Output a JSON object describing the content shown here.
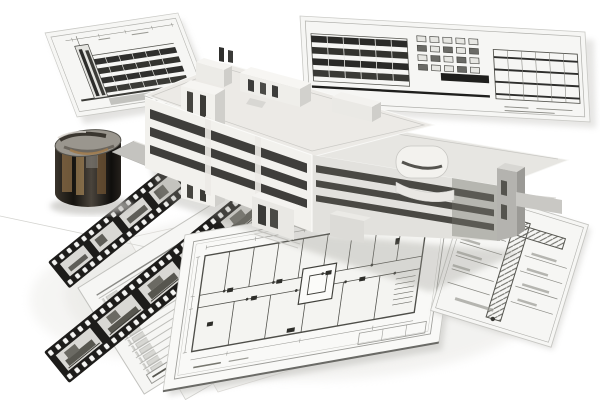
{
  "scene": {
    "title": "Architectural design collage",
    "description": "Grayscale photographic collage: a 3D white model of a modern multi-storey building stands on a gray platform surrounded by tilted blueprint boards with elevation drawings, flat floor-plan and construction-detail sheets, schedule forms with small tan plan thumbnails, a black film strip with building photo frames, and a dark sepia cylinder wrapped with an interior panorama.",
    "elements": {
      "board_left": {
        "label": "elevation blueprint board (top left)",
        "description": "Tilted board with a building elevation drawing: left stair tower and four dark horizontal window bands with dimension ticks above."
      },
      "board_right": {
        "label": "elevation blueprint board (top right)",
        "description": "Tilted board with gridded facade elevations, rows of small window boxes and a heavy dark datum band."
      },
      "building": {
        "label": "3D building model",
        "description": "White perspective model of an L-shaped office block: tall left slab with three dark ribbon-window bands, left stair tower, rooftop penthouses and chimneys, lower right wing with rounded corner feature and darker end block, entrance annexes at grade."
      },
      "platform": {
        "label": "gray base platform",
        "description": "Flat gray walkway and wedge-shaped base plane the model stands on."
      },
      "sheet_plan": {
        "label": "floor plan sheet",
        "description": "Large rotated drawing sheet with a rectangular floor plan: corridor, room partitions, core square, door marks, stair hatch, dimension strings and a title block."
      },
      "sheet_detail": {
        "label": "construction detail sheet (right)",
        "description": "Rotated sheet with a hatched wall/column section and leader-line annotations on both sides."
      },
      "sheet_form": {
        "label": "schedule form sheets (bottom left)",
        "description": "Stacked ruled form sheets with a hatched cell column and three small tan floor-plan thumbnails."
      },
      "film_strip_long": {
        "label": "film strip (long)",
        "description": "Black 35mm-style strip, sprocket holes both edges, five grayscale building-photo frames, running diagonally from lower left."
      },
      "film_strip_short": {
        "label": "film strip (short)",
        "description": "Second shorter film strip passing behind the cylinder."
      },
      "cylinder": {
        "label": "panorama cylinder",
        "description": "Dark sepia cylinder with a wrapped interior photograph; lighter swirled interior visible on its tilted top."
      }
    },
    "counts": {
      "blueprint_boards": 2,
      "flat_sheets": 5,
      "film_frames_long_strip": 5,
      "film_frames_short_strip": 4,
      "facade_window_bands": 3,
      "form_thumbnails": 3
    }
  },
  "colors": {
    "background": "#ffffff",
    "sheet_white": "#f6f6f4",
    "sheet_edge": "#c9c9c5",
    "line_dark": "#4e4e49",
    "line_mid": "#9a9a96",
    "band_dark": "#3f3e3b",
    "film_dark": "#1d1c1a",
    "film_frame": "#d9d8d4",
    "platform_gray": "#c4c3bf",
    "building_light": "#f2f1ed",
    "building_top": "#f6f5f2",
    "building_side": "#d0cfcb",
    "building_dark": "#b4b3af",
    "cylinder_dark": "#17150f",
    "cylinder_tan": "#8a6b45",
    "cylinder_gray": "#8d8a84",
    "thumb_tan": "#cfc68f",
    "shadow_soft": "#dcdbd7"
  }
}
